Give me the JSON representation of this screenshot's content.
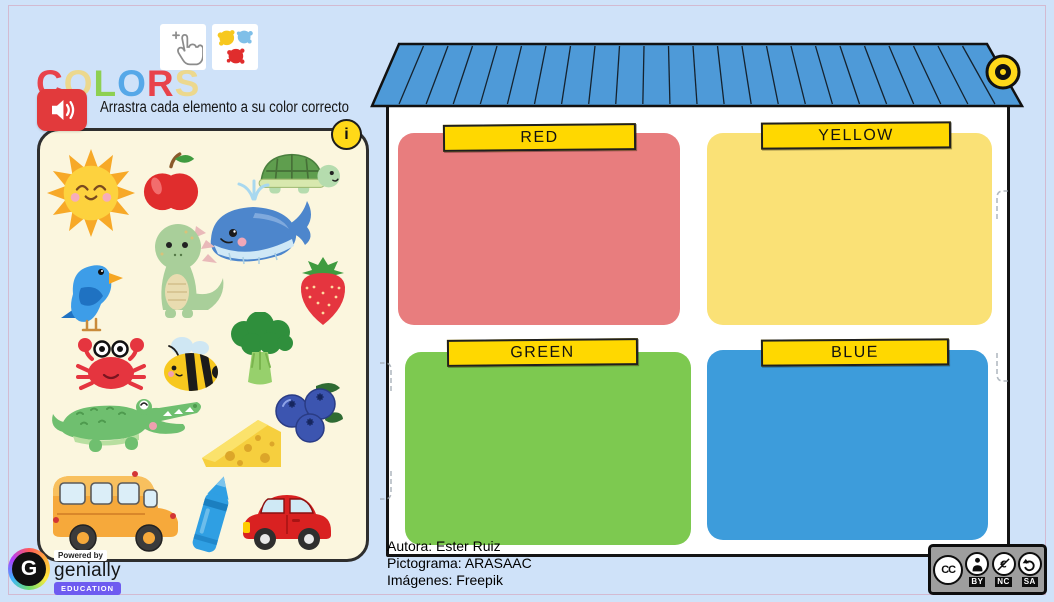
{
  "header": {
    "title": "COLORS",
    "title_letters": [
      {
        "ch": "C",
        "color": "#e8434b"
      },
      {
        "ch": "O",
        "color": "#ecd88e"
      },
      {
        "ch": "L",
        "color": "#8ed052"
      },
      {
        "ch": "O",
        "color": "#56a8e8"
      },
      {
        "ch": "R",
        "color": "#e8434b"
      },
      {
        "ch": "S",
        "color": "#ecd88e"
      }
    ],
    "instruction": "Arrastra cada elemento a su color correcto",
    "cursor_icon": "click-hand-icon",
    "palette_icon": "paint-splats-icon",
    "audio_icon": "speaker-icon"
  },
  "info_button": {
    "label": "i"
  },
  "tray": {
    "items": [
      "sun",
      "apple",
      "turtle",
      "whale",
      "dinosaur",
      "bird",
      "strawberry",
      "crab",
      "bee",
      "broccoli",
      "crocodile",
      "blueberries",
      "cheese",
      "bus",
      "crayon",
      "car"
    ]
  },
  "zones": [
    {
      "label": "RED",
      "color": "#e87d7e"
    },
    {
      "label": "YELLOW",
      "color": "#fae176"
    },
    {
      "label": "GREEN",
      "color": "#7dc950"
    },
    {
      "label": "BLUE",
      "color": "#3d9cdb"
    }
  ],
  "house": {
    "roof_color": "#4e9ad8",
    "wall_color": "#ffffff",
    "ornament_color": "#ffd81a"
  },
  "credits": {
    "lines": [
      "Autora: Ester Ruiz",
      "Pictograma: ARASAAC",
      "Imágenes: Freepik"
    ]
  },
  "genially": {
    "powered_by": "Powered by",
    "brand": "genially",
    "badge": "EDUCATION",
    "logo_letter": "G"
  },
  "license": {
    "cc": "CC",
    "labels": [
      "BY",
      "NC",
      "SA"
    ]
  },
  "colors": {
    "background": "#cfe2f9",
    "panel": "#fbf6de",
    "banner": "#ffd800",
    "accent_red": "#e23a3c",
    "info_yellow": "#ffd918"
  }
}
